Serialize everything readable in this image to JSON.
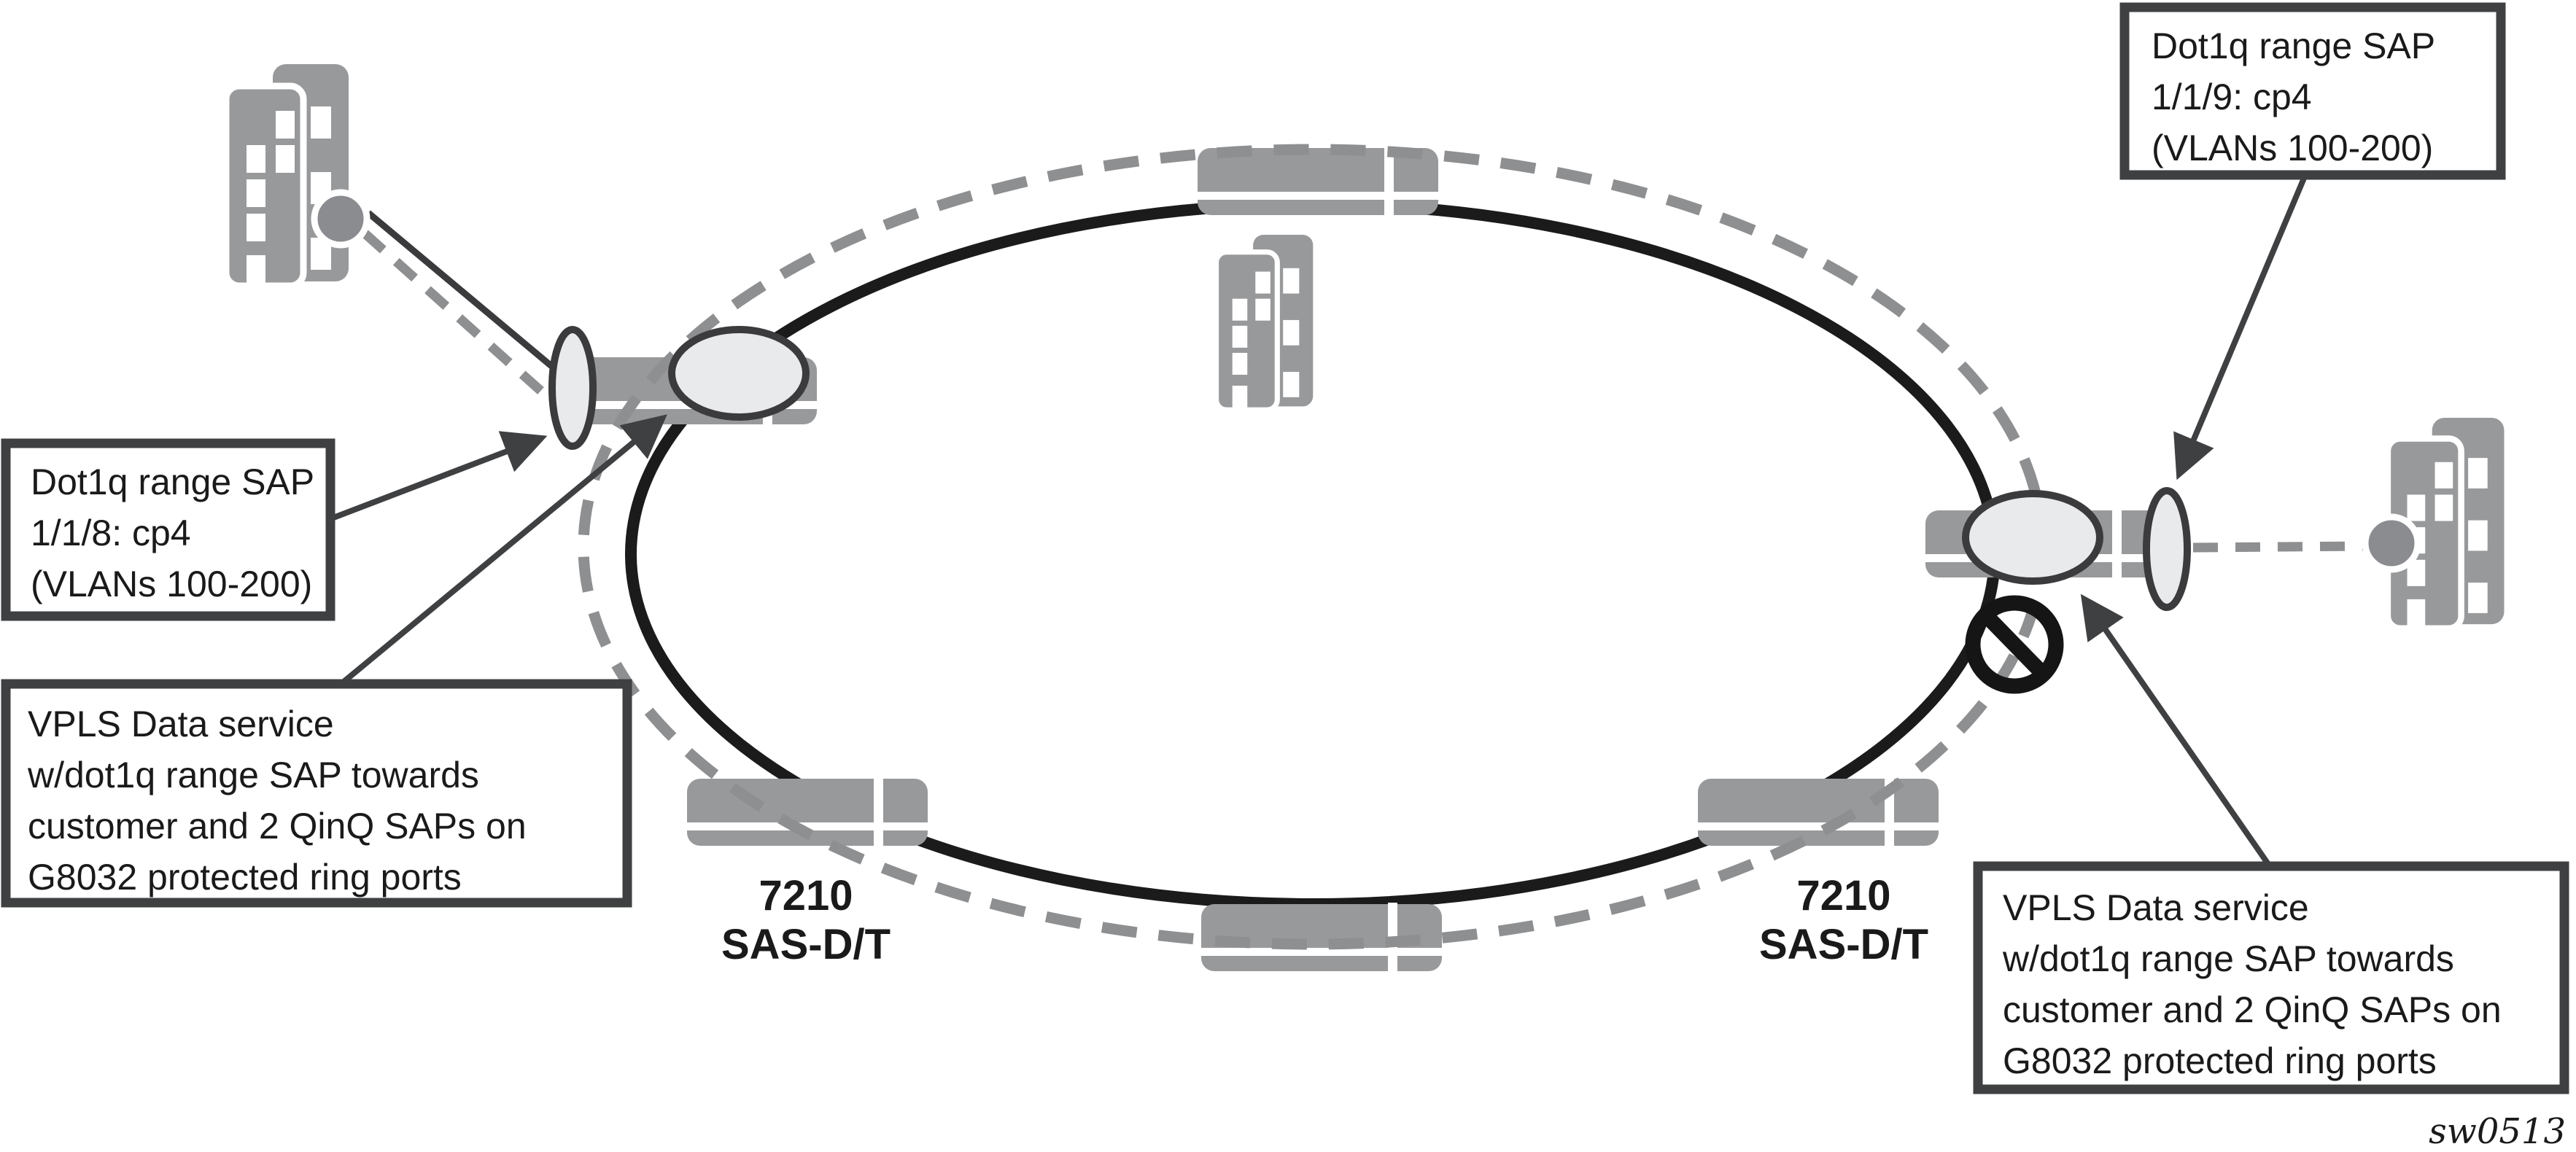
{
  "diagram": {
    "figure_id": "sw0513",
    "colors": {
      "bar_gray": "#98999b",
      "ring_dash": "#8e8f91",
      "ring_solid": "#1b1b1b",
      "node_fill": "#e9eaeb",
      "node_stroke": "#3b3b3d",
      "callout_border": "#3f4042",
      "building_gray": "#98999b",
      "building_dot": "#8a8c8f",
      "blocked": "#151515",
      "text": "#1a1a1a"
    },
    "ring": {
      "type": "G8032 protected ethernet ring",
      "outer_style": "dashed gray ellipse",
      "inner_style": "solid black ellipse"
    },
    "callouts": {
      "left_dot1q": {
        "lines": [
          "Dot1q range SAP",
          "1/1/8: cp4",
          "(VLANs 100-200)"
        ]
      },
      "left_vpls": {
        "lines": [
          "VPLS Data service",
          "w/dot1q range SAP towards",
          "customer and 2 QinQ SAPs on",
          "G8032 protected ring ports"
        ]
      },
      "right_dot1q": {
        "lines": [
          "Dot1q range SAP",
          "1/1/9: cp4",
          "(VLANs 100-200)"
        ]
      },
      "right_vpls": {
        "lines": [
          "VPLS Data service",
          "w/dot1q range SAP towards",
          "customer and 2 QinQ SAPs on",
          "G8032 protected ring ports"
        ]
      }
    },
    "nodes": {
      "left": {
        "label_lines": [
          "7210",
          "SAS-D/T"
        ]
      },
      "right": {
        "label_lines": [
          "7210",
          "SAS-D/T"
        ]
      }
    },
    "icons": {
      "building": "two gray towers with white windows",
      "customer-port-dot": "gray circle with white rim",
      "ring-node": "light gray ellipse on router bar",
      "sap-port-lens": "light gray vertical lens",
      "blocked-port": "no-entry circle with slash (RPL blocked port)"
    }
  }
}
